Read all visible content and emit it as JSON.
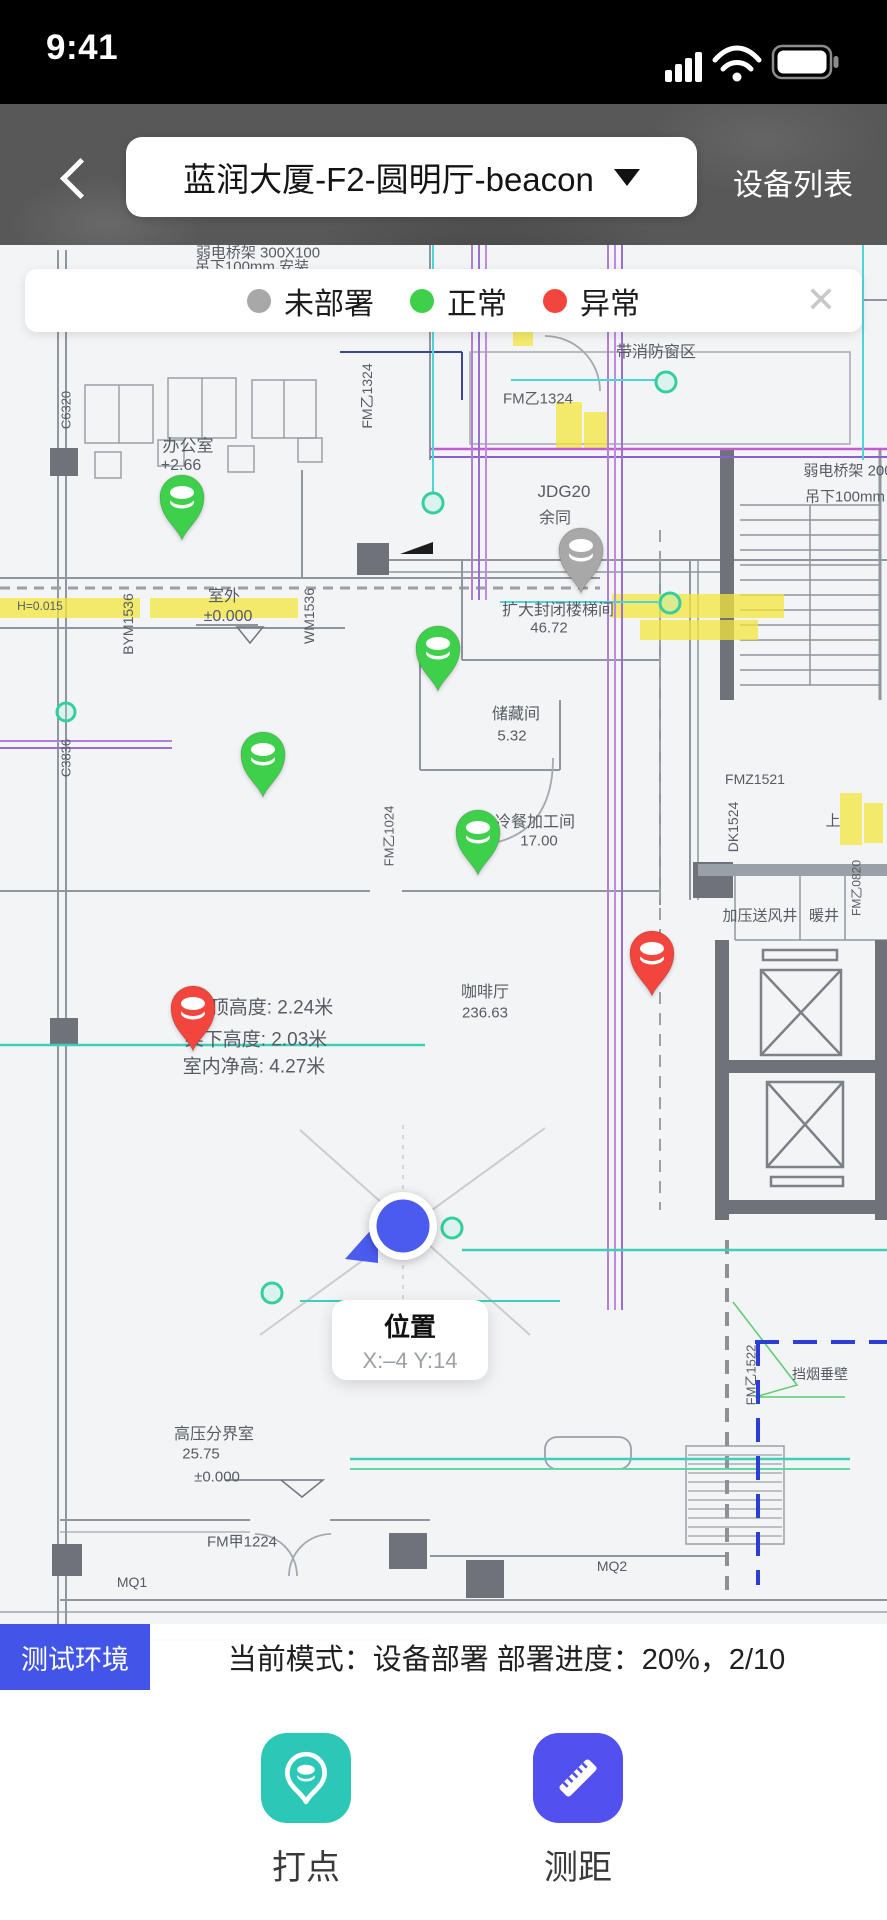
{
  "colors": {
    "pins": {
      "undeployed": "#a8a8a8",
      "normal": "#3ed04b",
      "abnormal": "#f2453d"
    },
    "location_blue": "#4a5bee",
    "env_badge_blue": "#4355e8",
    "mark_button_teal": "#2cc8b7",
    "measure_button_indigo": "#5350f0"
  },
  "status_bar": {
    "time": "9:41",
    "icons": [
      "signal-bars",
      "wifi",
      "battery-full"
    ]
  },
  "header": {
    "title": "蓝润大厦-F2-圆明厅-beacon",
    "right_action": "设备列表"
  },
  "legend": {
    "items": [
      {
        "label": "未部署",
        "color": "#a8a8a8"
      },
      {
        "label": "正常",
        "color": "#3ed04b"
      },
      {
        "label": "异常",
        "color": "#f2453d"
      }
    ],
    "close_label": "✕"
  },
  "map": {
    "pins": [
      {
        "status": "normal",
        "x": 182,
        "y": 542
      },
      {
        "status": "undeployed",
        "x": 581,
        "y": 595
      },
      {
        "status": "normal",
        "x": 438,
        "y": 693
      },
      {
        "status": "normal",
        "x": 263,
        "y": 799
      },
      {
        "status": "normal",
        "x": 478,
        "y": 877
      },
      {
        "status": "abnormal",
        "x": 652,
        "y": 998
      },
      {
        "status": "abnormal",
        "x": 193,
        "y": 1053
      }
    ],
    "location": {
      "x": 403,
      "y": 1226,
      "tooltip_title": "位置",
      "tooltip_coords": "X:–4 Y:14"
    },
    "plan_labels": [
      {
        "text": "弱电桥架 300X100",
        "x": 258,
        "y": 252,
        "s": 15
      },
      {
        "text": "吊下100mm 安装",
        "x": 252,
        "y": 266,
        "s": 15
      },
      {
        "text": "带消防窗区",
        "x": 656,
        "y": 350,
        "s": 16
      },
      {
        "text": "FM乙1324",
        "x": 367,
        "y": 396,
        "s": 14,
        "rot": 1
      },
      {
        "text": "FM乙1324",
        "x": 538,
        "y": 398,
        "s": 15
      },
      {
        "text": "办公室",
        "x": 188,
        "y": 444,
        "s": 17
      },
      {
        "text": "+2.66",
        "x": 181,
        "y": 466,
        "s": 16
      },
      {
        "text": "弱电桥架 200",
        "x": 848,
        "y": 470,
        "s": 15
      },
      {
        "text": "吊下100mm",
        "x": 845,
        "y": 496,
        "s": 15
      },
      {
        "text": "JDG20",
        "x": 564,
        "y": 492,
        "s": 17
      },
      {
        "text": "余同",
        "x": 555,
        "y": 516,
        "s": 16
      },
      {
        "text": "C6320",
        "x": 66,
        "y": 410,
        "s": 13,
        "rot": 1
      },
      {
        "text": "室外",
        "x": 224,
        "y": 594,
        "s": 16
      },
      {
        "text": "±0.000",
        "x": 228,
        "y": 617,
        "s": 16
      },
      {
        "text": "H=0.015",
        "x": 40,
        "y": 606,
        "s": 12
      },
      {
        "text": "BYM1536",
        "x": 128,
        "y": 624,
        "s": 14,
        "rot": 1
      },
      {
        "text": "WM1536",
        "x": 309,
        "y": 616,
        "s": 14,
        "rot": 1
      },
      {
        "text": "扩大封闭楼梯间",
        "x": 558,
        "y": 608,
        "s": 16
      },
      {
        "text": "46.72",
        "x": 549,
        "y": 628,
        "s": 15
      },
      {
        "text": "储藏间",
        "x": 516,
        "y": 712,
        "s": 16
      },
      {
        "text": "5.32",
        "x": 512,
        "y": 736,
        "s": 15
      },
      {
        "text": "C3836",
        "x": 66,
        "y": 758,
        "s": 13,
        "rot": 1
      },
      {
        "text": "FMZ1521",
        "x": 755,
        "y": 779,
        "s": 14
      },
      {
        "text": "冷餐加工间",
        "x": 535,
        "y": 820,
        "s": 16
      },
      {
        "text": "17.00",
        "x": 539,
        "y": 841,
        "s": 15
      },
      {
        "text": "DK1524",
        "x": 733,
        "y": 827,
        "s": 14,
        "rot": 1
      },
      {
        "text": "FM乙1024",
        "x": 388,
        "y": 836,
        "s": 13,
        "rot": 1
      },
      {
        "text": "上",
        "x": 833,
        "y": 820,
        "s": 15
      },
      {
        "text": "加压送风井",
        "x": 760,
        "y": 915,
        "s": 15
      },
      {
        "text": "暖井",
        "x": 824,
        "y": 915,
        "s": 15
      },
      {
        "text": "FM乙0820",
        "x": 856,
        "y": 888,
        "s": 12,
        "rot": 1
      },
      {
        "text": "咖啡厅",
        "x": 485,
        "y": 990,
        "s": 16
      },
      {
        "text": "236.63",
        "x": 485,
        "y": 1013,
        "s": 15
      },
      {
        "text": "吊顶高度: 2.24米",
        "x": 262,
        "y": 1006,
        "s": 19
      },
      {
        "text": "梁下高度: 2.03米",
        "x": 256,
        "y": 1038,
        "s": 19
      },
      {
        "text": "室内净高: 4.27米",
        "x": 254,
        "y": 1065,
        "s": 19
      },
      {
        "text": "FM乙1522",
        "x": 750,
        "y": 1375,
        "s": 13,
        "rot": 1
      },
      {
        "text": "挡烟垂壁",
        "x": 820,
        "y": 1374,
        "s": 14
      },
      {
        "text": "高压分界室",
        "x": 214,
        "y": 1432,
        "s": 16
      },
      {
        "text": "25.75",
        "x": 201,
        "y": 1454,
        "s": 15
      },
      {
        "text": "±0.000",
        "x": 217,
        "y": 1477,
        "s": 15
      },
      {
        "text": "FM甲1224",
        "x": 242,
        "y": 1541,
        "s": 15
      },
      {
        "text": "MQ1",
        "x": 132,
        "y": 1582,
        "s": 14
      },
      {
        "text": "MQ2",
        "x": 612,
        "y": 1566,
        "s": 14
      }
    ]
  },
  "info_bar": {
    "env_badge": "测试环境",
    "mode_text": "当前模式：设备部署 部署进度：20%，2/10"
  },
  "actions": {
    "mark_label": "打点",
    "measure_label": "测距"
  }
}
